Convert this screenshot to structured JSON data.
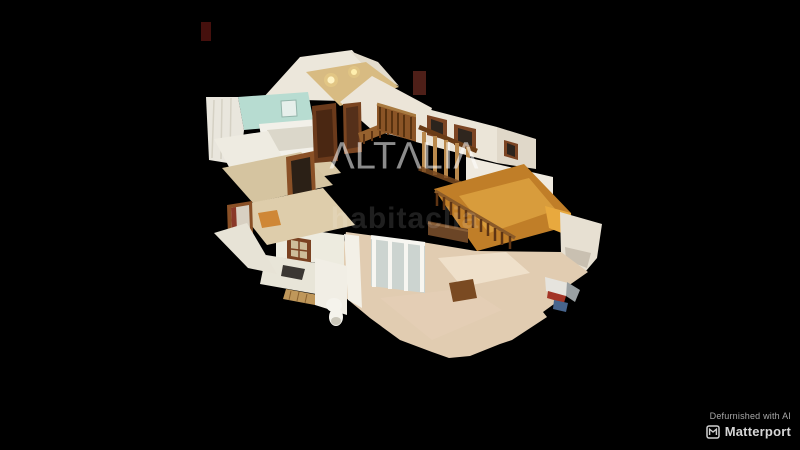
{
  "viewer": {
    "type": "matterport-3d-dollhouse-view",
    "background_color": "#000000"
  },
  "watermarks": {
    "primary": "ΛLTΛLIΛ",
    "secondary": "habitaclia"
  },
  "attribution": {
    "defurnished": "Defurnished with AI",
    "brand": "Matterport",
    "brand_icon": "matterport-m-logo"
  },
  "colors": {
    "background": "#000000",
    "wood_floor": "#c07e28",
    "wall_white": "#ece6da",
    "floor_cream": "#e1ccb1",
    "bathroom_teal": "#b7dcd1",
    "wood_trim": "#7c4524",
    "chimney_red": "#45100d",
    "watermark": "#ffffff"
  }
}
